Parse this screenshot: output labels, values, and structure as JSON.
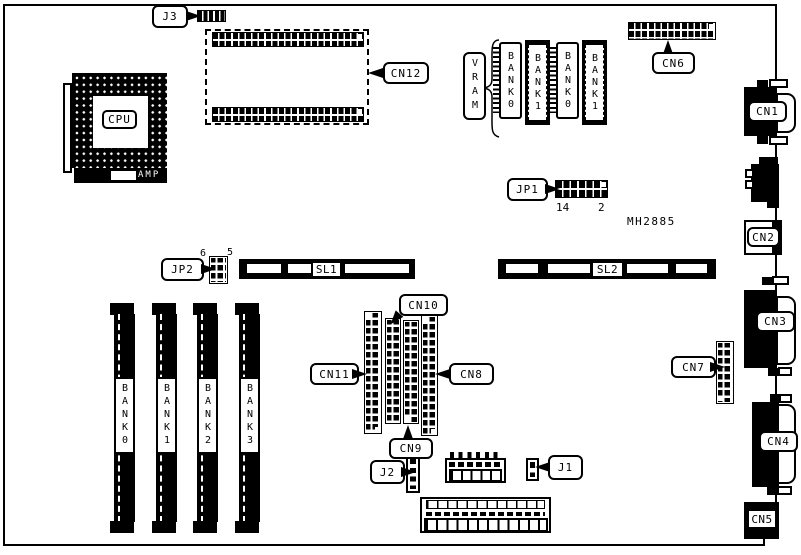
{
  "board": {
    "part_number": "MH2885",
    "cpu": {
      "label": "CPU",
      "maker": "AMP"
    },
    "callouts": {
      "j3": "J3",
      "cn12": "CN12",
      "cn6": "CN6",
      "cn7": "CN7",
      "cn8": "CN8",
      "cn9": "CN9",
      "cn10": "CN10",
      "cn11": "CN11",
      "j1": "J1",
      "j2": "J2"
    },
    "jumpers": {
      "jp1": {
        "label": "JP1",
        "pin_left": "14",
        "pin_right": "2"
      },
      "jp2": {
        "label": "JP2",
        "pin_left": "6",
        "pin_right": "5"
      }
    },
    "vram": {
      "label": "VRAM",
      "chips": [
        "BANK0",
        "BANK1",
        "BANK0",
        "BANK1"
      ]
    },
    "simm_banks": [
      "BANK0",
      "BANK1",
      "BANK2",
      "BANK3"
    ],
    "slots": {
      "sl1": "SL1",
      "sl2": "SL2"
    },
    "rear_connectors": {
      "cn1": "CN1",
      "cn2": "CN2",
      "cn3": "CN3",
      "cn4": "CN4",
      "cn5": "CN5"
    }
  }
}
